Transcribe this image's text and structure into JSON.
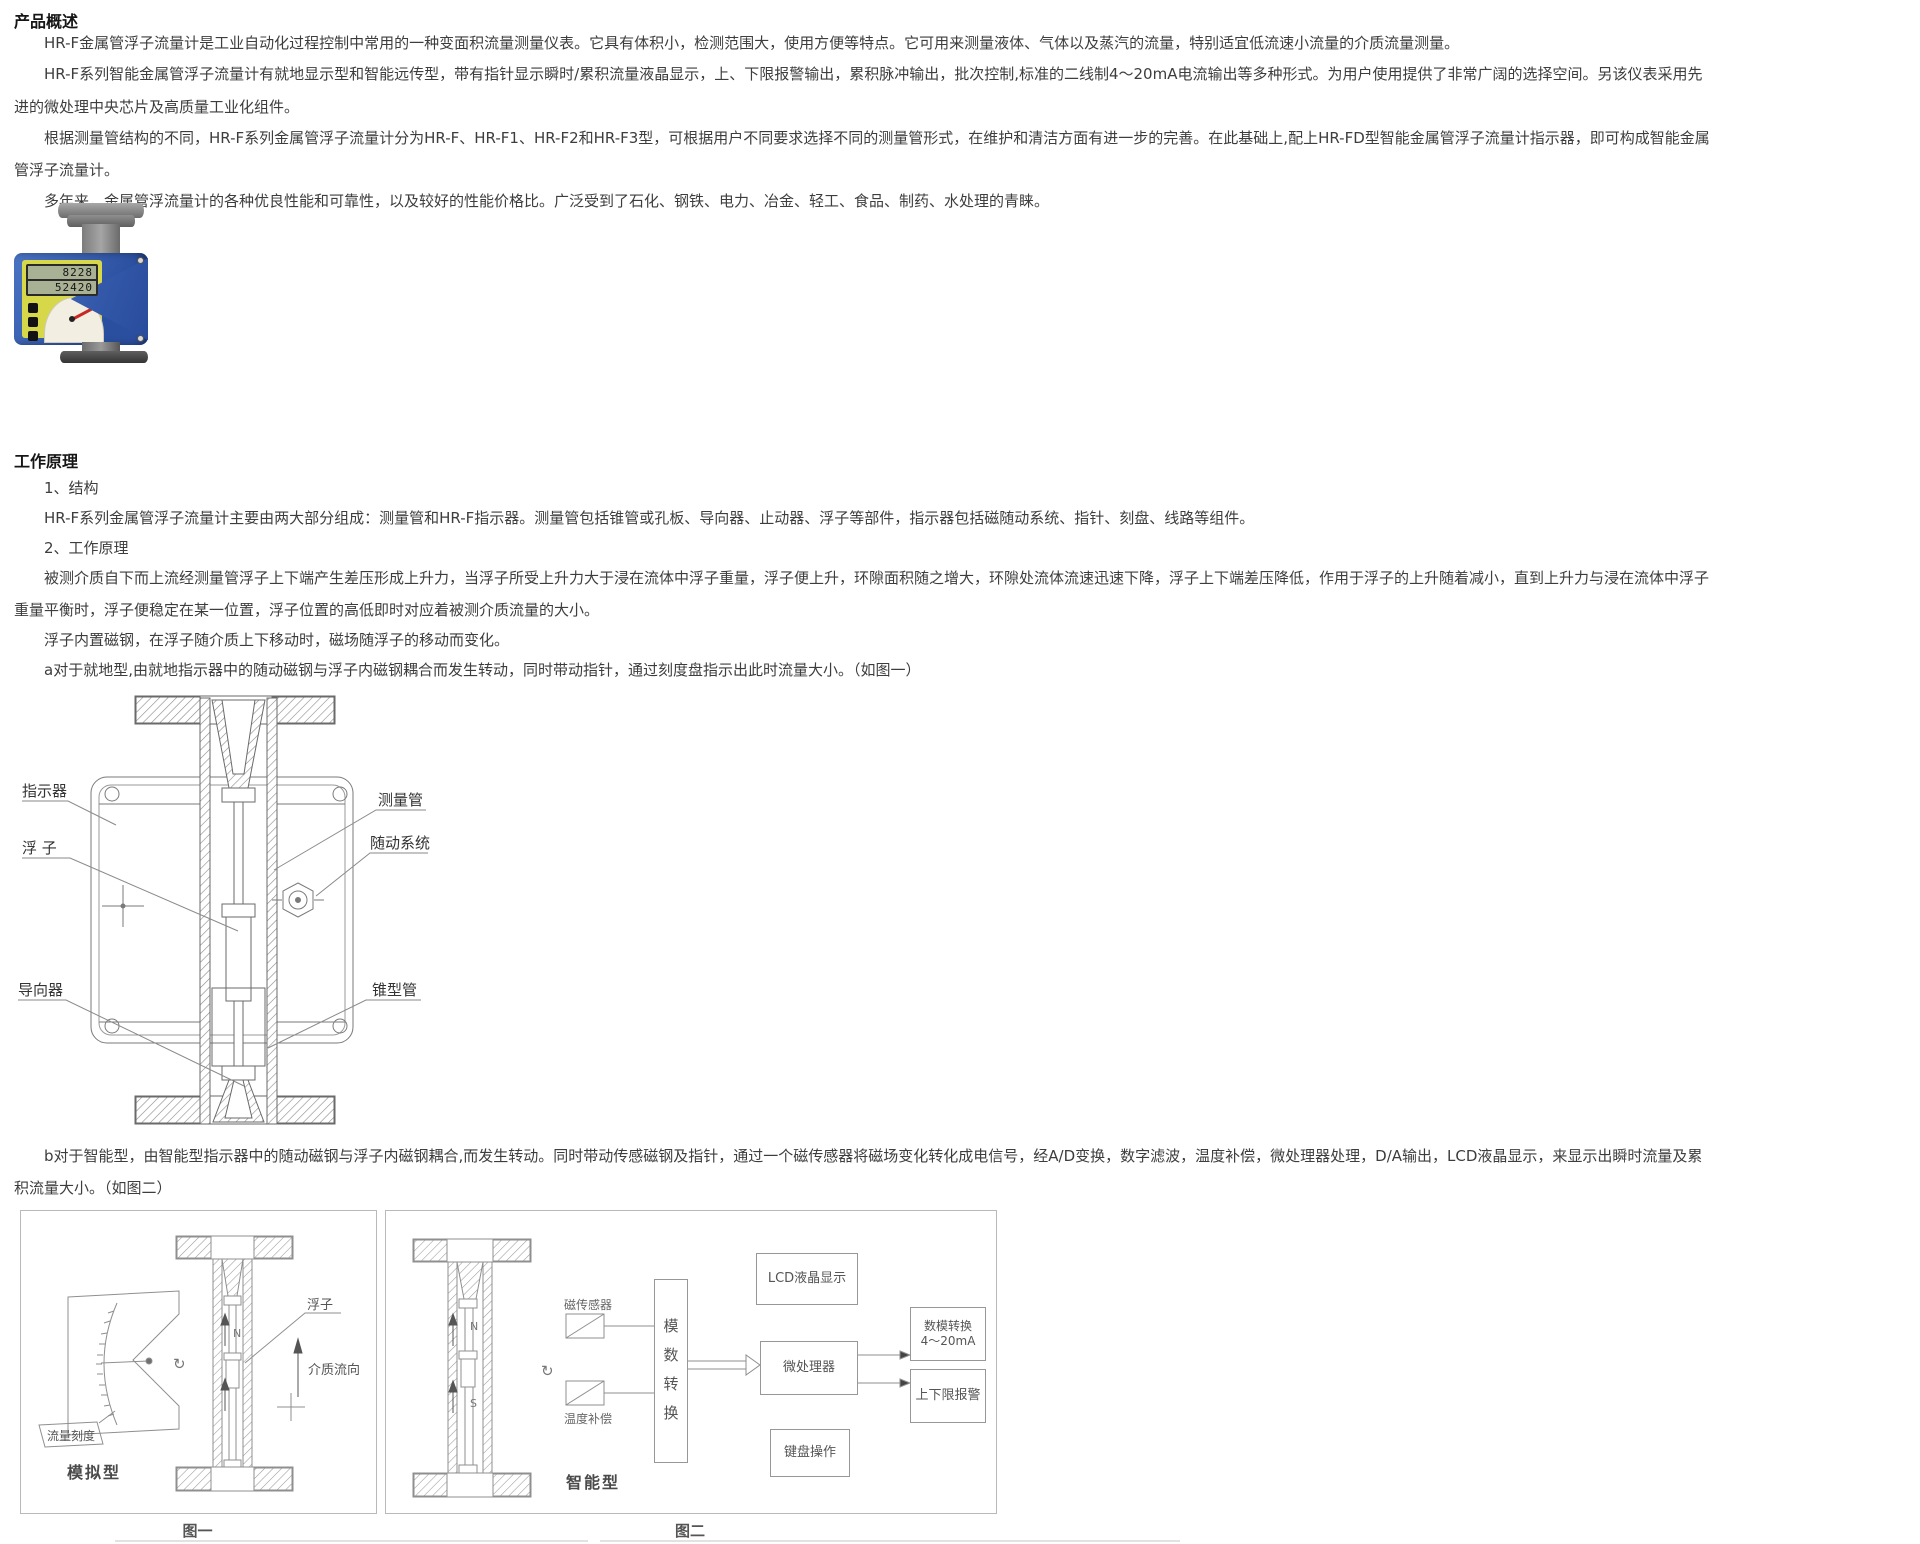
{
  "overview": {
    "heading": "产品概述",
    "p1": "HR-F金属管浮子流量计是工业自动化过程控制中常用的一种变面积流量测量仪表。它具有体积小，检测范围大，使用方便等特点。它可用来测量液体、气体以及蒸汽的流量，特别适宜低流速小流量的介质流量测量。",
    "p2a": "HR-F系列智能金属管浮子流量计有就地显示型和智能远传型，带有指针显示瞬时/累积流量液晶显示，上、下限报警输出，累积脉冲输出，批次控制,标准的二线制4～20mA电流输出等多种形式。为用户使用提供了非常广阔的选择空间。另该仪表采用先",
    "p2b": "进的微处理中央芯片及高质量工业化组件。",
    "p3a": "根据测量管结构的不同，HR-F系列金属管浮子流量计分为HR-F、HR-F1、HR-F2和HR-F3型，可根据用户不同要求选择不同的测量管形式，在维护和清洁方面有进一步的完善。在此基础上,配上HR-FD型智能金属管浮子流量计指示器，即可构成智能金属",
    "p3b": "管浮子流量计。",
    "p4": "多年来，金属管浮流量计的各种优良性能和可靠性，以及较好的性能价格比。广泛受到了石化、钢铁、电力、冶金、轻工、食品、制药、水处理的青睐。"
  },
  "device": {
    "lcd_row1": "8228",
    "lcd_row2": "52420",
    "body_color": "#3a61b0",
    "panel_color": "#d6d84a",
    "needle_color": "#c82822"
  },
  "principle": {
    "heading": "工作原理",
    "item1": "1、结构",
    "item1_text": "HR-F系列金属管浮子流量计主要由两大部分组成：测量管和HR-F指示器。测量管包括锥管或孔板、导向器、止动器、浮子等部件，指示器包括磁随动系统、指针、刻盘、线路等组件。",
    "item2": "2、工作原理",
    "p1a": "被测介质自下而上流经测量管浮子上下端产生差压形成上升力，当浮子所受上升力大于浸在流体中浮子重量，浮子便上升，环隙面积随之增大，环隙处流体流速迅速下降，浮子上下端差压降低，作用于浮子的上升随着减小，直到上升力与浸在流体中浮子",
    "p1b": "重量平衡时，浮子便稳定在某一位置，浮子位置的高低即时对应着被测介质流量的大小。",
    "p2": "浮子内置磁钢，在浮子随介质上下移动时，磁场随浮子的移动而变化。",
    "p3": "a对于就地型,由就地指示器中的随动磁钢与浮子内磁钢耦合而发生转动，同时带动指针，通过刻度盘指示出此时流量大小。（如图一）",
    "p4a": "b对于智能型，由智能型指示器中的随动磁钢与浮子内磁钢耦合,而发生转动。同时带动传感磁钢及指针，通过一个磁传感器将磁场变化转化成电信号，经A/D变换，数字滤波，温度补偿，微处理器处理，D/A输出，LCD液晶显示，来显示出瞬时流量及累",
    "p4b": "积流量大小。（如图二）"
  },
  "diagram": {
    "indicator": "指示器",
    "float": "浮 子",
    "guide": "导向器",
    "tube": "测量管",
    "follower": "随动系统",
    "cone": "锥型管"
  },
  "figure1": {
    "float": "浮子",
    "flow": "介质流向",
    "scale": "流量刻度",
    "type": "模拟型",
    "caption": "图一",
    "n": "N",
    "rotation": "↻"
  },
  "figure2": {
    "sensor": "磁传感器",
    "temp": "温度补偿",
    "adc": "模数转换",
    "lcd": "LCD液晶显示",
    "mcu": "微处理器",
    "keypad": "键盘操作",
    "dac_line1": "数模转换",
    "dac_line2": "4～20mA",
    "alarm": "上下限报警",
    "type": "智能型",
    "caption": "图二",
    "n": "N",
    "s": "S",
    "rotation": "↻"
  }
}
